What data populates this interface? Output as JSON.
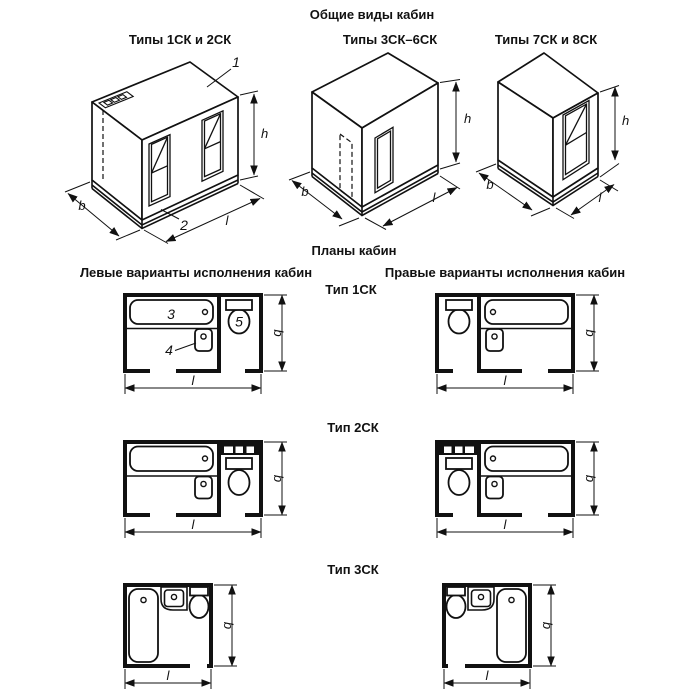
{
  "figure": {
    "background": "#ffffff",
    "ink": "#111111"
  },
  "dim_labels": {
    "width": "b",
    "length": "l",
    "height": "h"
  },
  "callouts": {
    "cabin_panel": "1",
    "base": "2",
    "bath": "3",
    "washbasin": "4",
    "toilet": "5"
  },
  "general_views": {
    "title": "Общие виды кабин",
    "view_labels": [
      "Типы 1СК и 2СК",
      "Типы 3СК–6СК",
      "Типы 7СК и 8СК"
    ]
  },
  "plans": {
    "title": "Планы кабин",
    "left_heading": "Левые варианты исполнения кабин",
    "right_heading": "Правые варианты исполнения кабин",
    "type_labels": [
      "Тип 1СК",
      "Тип 2СК",
      "Тип 3СК"
    ]
  }
}
